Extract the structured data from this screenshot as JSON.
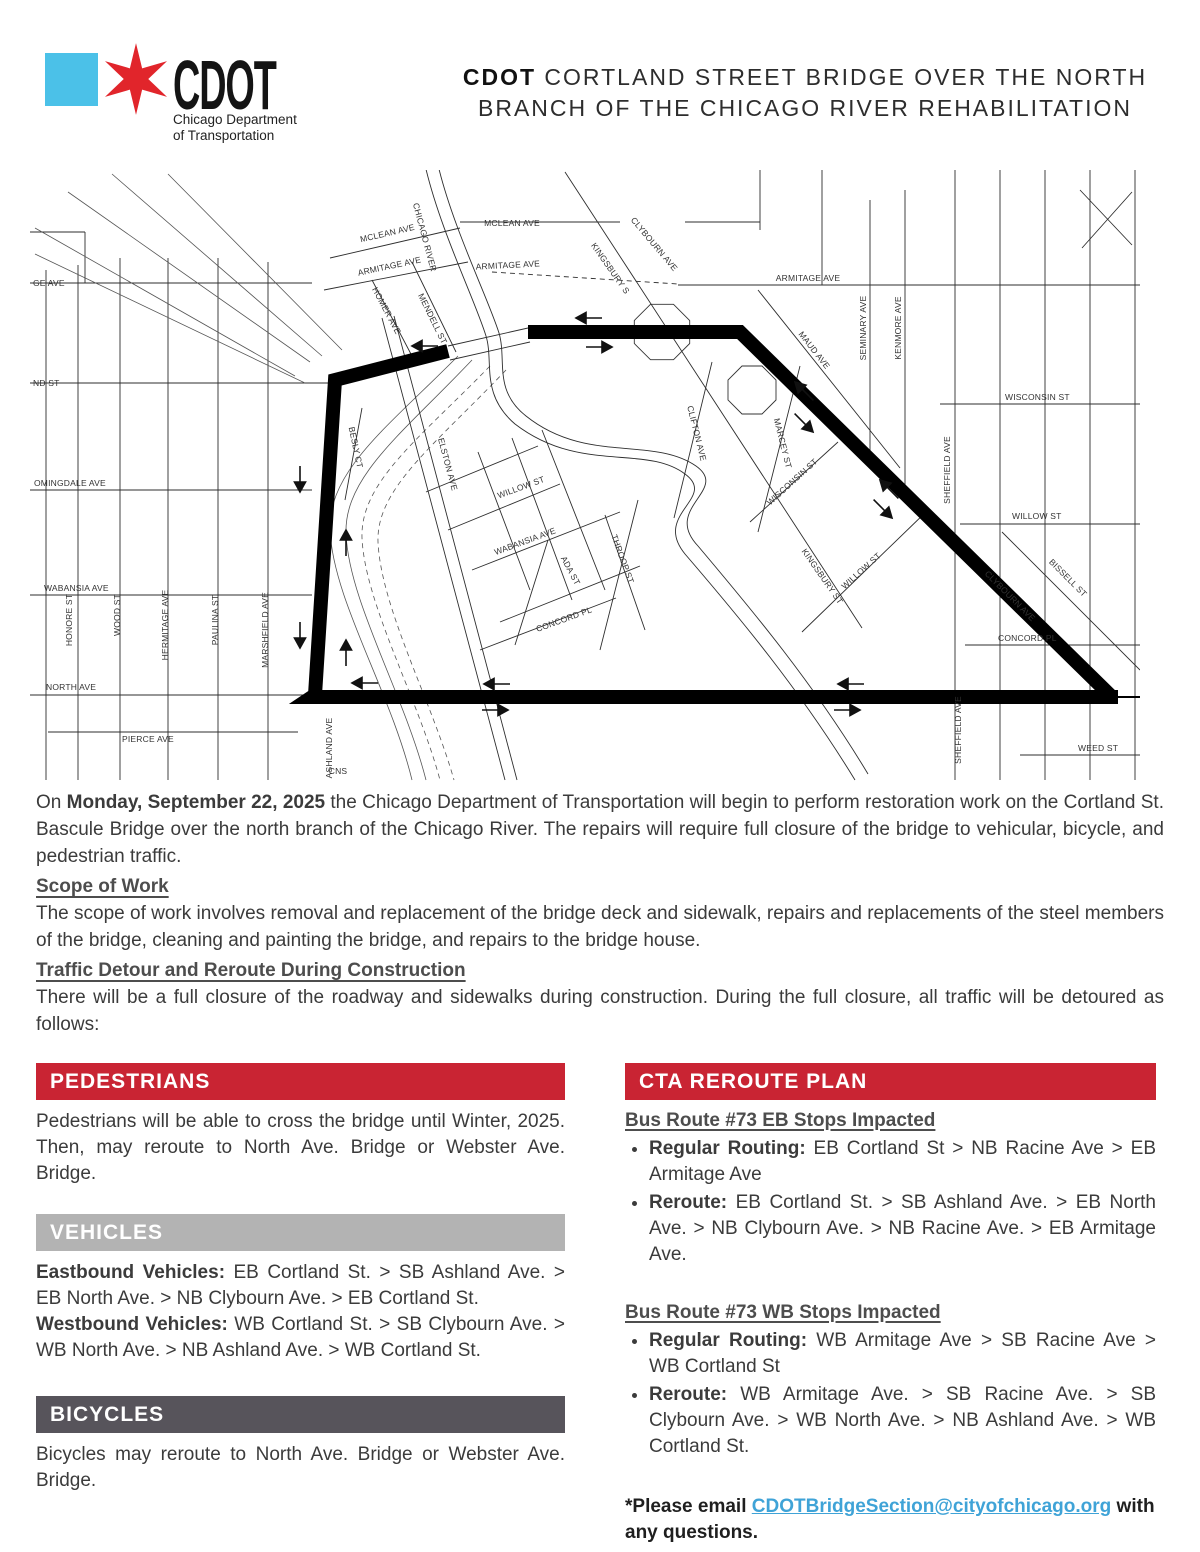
{
  "logo": {
    "square_color": "#4bc1e8",
    "star_color": "#e1252b",
    "acronym": "CDOT",
    "dept1": "Chicago Department",
    "dept2": "of Transportation"
  },
  "header": {
    "title_bold": "CDOT",
    "title_rest": " CORTLAND STREET BRIDGE OVER THE NORTH BRANCH OF THE CHICAGO RIVER REHABILITATION"
  },
  "intro": {
    "pre": "On ",
    "date": "Monday, September 22, 2025",
    "post": " the Chicago Department of Transportation will begin to perform restoration work on the Cortland St. Bascule Bridge over the north branch of the Chicago River. The repairs will require full closure of the bridge to vehicular, bicycle, and pedestrian traffic."
  },
  "scope": {
    "heading": "Scope of Work",
    "body": "The scope of work involves removal and replacement of the bridge deck and sidewalk, repairs and replacements of the steel members of the bridge, cleaning and painting the bridge, and repairs to the bridge house."
  },
  "traffic": {
    "heading": "Traffic Detour and Reroute During Construction",
    "body": "There will be a full closure of the roadway and sidewalks during construction. During the full closure, all traffic will be detoured as follows:"
  },
  "pedestrians": {
    "heading": "PEDESTRIANS",
    "color": "#c92433",
    "body": "Pedestrians will be able to cross the bridge until Winter, 2025. Then, may reroute to North Ave. Bridge or Webster Ave. Bridge."
  },
  "vehicles": {
    "heading": "VEHICLES",
    "color": "#b3b3b3",
    "eb_label": "Eastbound Vehicles:",
    "eb_text": " EB Cortland St. > SB Ashland Ave. > EB North Ave. > NB Clybourn Ave. > EB Cortland St.",
    "wb_label": "Westbound Vehicles:",
    "wb_text": " WB Cortland St. > SB Clybourn Ave. > WB North Ave. > NB Ashland Ave. > WB Cortland St."
  },
  "bicycles": {
    "heading": "BICYCLES",
    "color": "#57545b",
    "body": "Bicycles may reroute to North Ave. Bridge or Webster Ave. Bridge."
  },
  "cta": {
    "heading": "CTA REROUTE PLAN",
    "color": "#c92433",
    "eb": {
      "heading": "Bus Route #73 EB Stops Impacted",
      "bullets": [
        {
          "label": "Regular Routing:",
          "text": " EB Cortland St > NB Racine Ave > EB Armitage Ave"
        },
        {
          "label": "Reroute:",
          "text": " EB Cortland St. > SB Ashland Ave. > EB North Ave. > NB Clybourn Ave. > NB Racine Ave. > EB Armitage Ave."
        }
      ]
    },
    "wb": {
      "heading": "Bus Route #73 WB Stops Impacted",
      "bullets": [
        {
          "label": "Regular Routing:",
          "text": " WB Armitage Ave > SB Racine Ave > WB Cortland St"
        },
        {
          "label": "Reroute:",
          "text": " WB Armitage Ave. > SB Racine Ave. > SB Clybourn Ave. > WB North Ave. > NB Ashland Ave. > WB Cortland St."
        }
      ]
    },
    "note": {
      "pre": "*Please email ",
      "link": "CDOTBridgeSection@cityofchicago.org",
      "post": " with any questions."
    }
  },
  "map": {
    "labels": [
      {
        "t": "GE AVE",
        "x": -27,
        "y": 116,
        "r": 0,
        "a": "s"
      },
      {
        "t": "ND ST",
        "x": -27,
        "y": 216,
        "r": 0,
        "a": "s"
      },
      {
        "t": "OMINGDALE AVE",
        "x": -26,
        "y": 316,
        "r": 0,
        "a": "s"
      },
      {
        "t": "WABANSIA AVE",
        "x": -16,
        "y": 421,
        "r": 0,
        "a": "s"
      },
      {
        "t": "NORTH AVE",
        "x": -14,
        "y": 520,
        "r": 0,
        "a": "s"
      },
      {
        "t": "PIERCE AVE",
        "x": 62,
        "y": 572,
        "r": 0,
        "a": "s"
      },
      {
        "t": "HONORE ST",
        "x": 12,
        "y": 450,
        "r": -90
      },
      {
        "t": "WOOD ST",
        "x": 60,
        "y": 445,
        "r": -90
      },
      {
        "t": "HERMITAGE AVE",
        "x": 108,
        "y": 455,
        "r": -90
      },
      {
        "t": "PAULINA ST",
        "x": 158,
        "y": 450,
        "r": -90
      },
      {
        "t": "MARSHFIELD AVE",
        "x": 208,
        "y": 460,
        "r": -90
      },
      {
        "t": "ASHLAND AVE",
        "x": 272,
        "y": 578,
        "r": -90
      },
      {
        "t": "CNS",
        "x": 278,
        "y": 604,
        "r": 0
      },
      {
        "t": "MCLEAN AVE",
        "x": 328,
        "y": 66,
        "r": -13
      },
      {
        "t": "ARMITAGE AVE",
        "x": 330,
        "y": 99,
        "r": -12
      },
      {
        "t": "MCLEAN AVE",
        "x": 452,
        "y": 56,
        "r": 0
      },
      {
        "t": "ARMITAGE AVE",
        "x": 448,
        "y": 98,
        "r": -3
      },
      {
        "t": "CHICAGO RIVER",
        "x": 362,
        "y": 68,
        "r": 75
      },
      {
        "t": "HOMER AVE",
        "x": 324,
        "y": 142,
        "r": 62
      },
      {
        "t": "MENDELL ST",
        "x": 370,
        "y": 150,
        "r": 64
      },
      {
        "t": "ELSTON AVE",
        "x": 385,
        "y": 295,
        "r": 75
      },
      {
        "t": "BESLY CT",
        "x": 293,
        "y": 278,
        "r": 78
      },
      {
        "t": "KINGSBURY S",
        "x": 548,
        "y": 100,
        "r": 55
      },
      {
        "t": "CLYBOURN AVE",
        "x": 592,
        "y": 76,
        "r": 50
      },
      {
        "t": "ARMITAGE AVE",
        "x": 748,
        "y": 111,
        "r": 0
      },
      {
        "t": "MAUD AVE",
        "x": 752,
        "y": 182,
        "r": 52
      },
      {
        "t": "SEMINARY AVE",
        "x": 806,
        "y": 158,
        "r": -90
      },
      {
        "t": "KENMORE AVE",
        "x": 841,
        "y": 158,
        "r": -90
      },
      {
        "t": "WISCONSIN ST",
        "x": 945,
        "y": 230,
        "r": 0,
        "a": "s"
      },
      {
        "t": "SHEFFIELD AVE",
        "x": 890,
        "y": 300,
        "r": -90
      },
      {
        "t": "WILLOW ST",
        "x": 952,
        "y": 349,
        "r": 0,
        "a": "s"
      },
      {
        "t": "CLIFTON AVE",
        "x": 634,
        "y": 264,
        "r": 76
      },
      {
        "t": "MARCEY ST",
        "x": 720,
        "y": 274,
        "r": 76
      },
      {
        "t": "WISCONSIN ST",
        "x": 734,
        "y": 314,
        "r": -42
      },
      {
        "t": "WILLOW ST",
        "x": 803,
        "y": 403,
        "r": -42
      },
      {
        "t": "KINGSBURY ST",
        "x": 760,
        "y": 408,
        "r": 55
      },
      {
        "t": "BISSELL ST",
        "x": 1006,
        "y": 410,
        "r": 45
      },
      {
        "t": "CLYBOURN AVE",
        "x": 948,
        "y": 428,
        "r": 45
      },
      {
        "t": "CONCORD PL",
        "x": 938,
        "y": 471,
        "r": 0,
        "a": "s"
      },
      {
        "t": "SHEFFIELD AVE",
        "x": 901,
        "y": 560,
        "r": -90
      },
      {
        "t": "WEED ST",
        "x": 1018,
        "y": 581,
        "r": 0,
        "a": "s"
      },
      {
        "t": "WILLOW ST",
        "x": 462,
        "y": 320,
        "r": -20
      },
      {
        "t": "WABANSIA AVE",
        "x": 466,
        "y": 374,
        "r": -20
      },
      {
        "t": "ADA ST",
        "x": 508,
        "y": 402,
        "r": 62
      },
      {
        "t": "CONCORD PL",
        "x": 505,
        "y": 452,
        "r": -20
      },
      {
        "t": "THROOP ST",
        "x": 560,
        "y": 390,
        "r": 70
      }
    ],
    "arrows": [
      {
        "x": 516,
        "y": 148,
        "a": 180
      },
      {
        "x": 552,
        "y": 177,
        "a": 0
      },
      {
        "x": 352,
        "y": 176,
        "a": 180
      },
      {
        "x": 240,
        "y": 322,
        "a": 90
      },
      {
        "x": 286,
        "y": 360,
        "a": -90
      },
      {
        "x": 240,
        "y": 478,
        "a": 90
      },
      {
        "x": 286,
        "y": 470,
        "a": -90
      },
      {
        "x": 292,
        "y": 513,
        "a": 180
      },
      {
        "x": 424,
        "y": 514,
        "a": 180
      },
      {
        "x": 448,
        "y": 540,
        "a": 0
      },
      {
        "x": 735,
        "y": 212,
        "a": -135
      },
      {
        "x": 753,
        "y": 262,
        "a": 45
      },
      {
        "x": 820,
        "y": 310,
        "a": -135
      },
      {
        "x": 832,
        "y": 348,
        "a": 45
      },
      {
        "x": 778,
        "y": 514,
        "a": 180
      },
      {
        "x": 800,
        "y": 540,
        "a": 0
      }
    ]
  }
}
